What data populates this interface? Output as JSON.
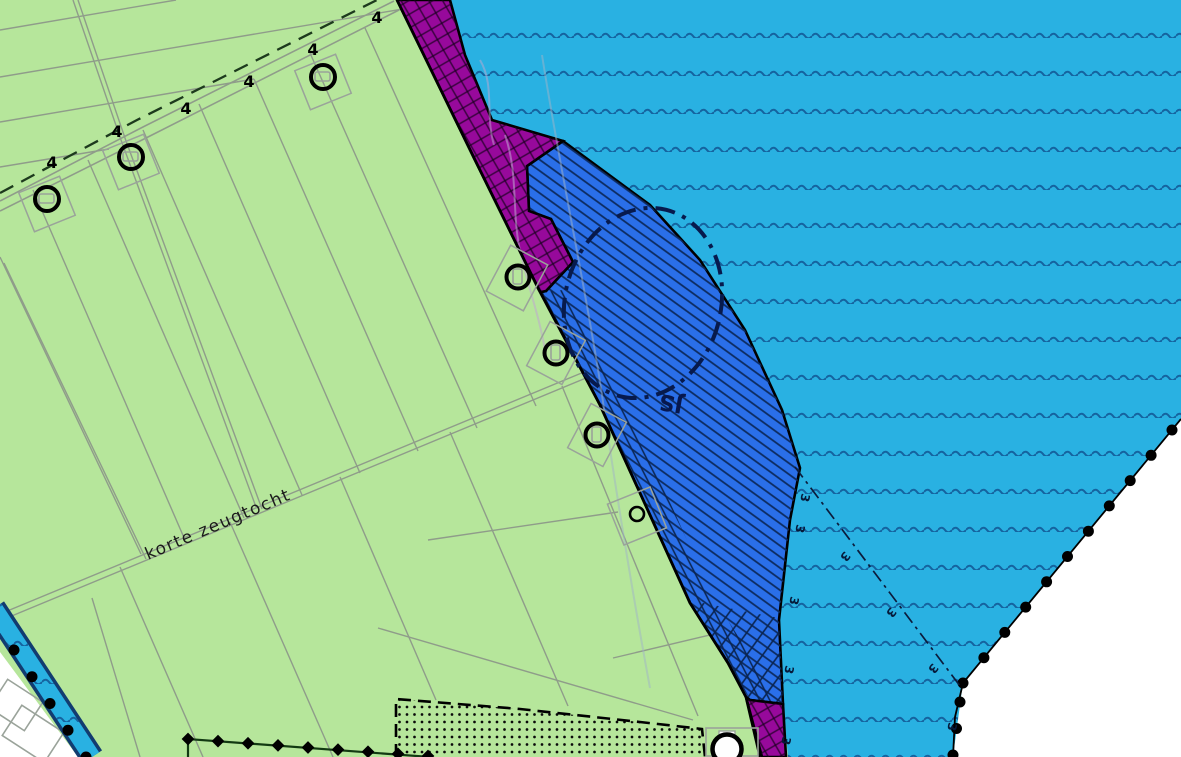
{
  "labels": {
    "waterway_name": "korte zeugtocht",
    "road_number": "4",
    "depth_number": "3",
    "area_code": "JS"
  },
  "colors": {
    "field_green": "#b6e69b",
    "water_cyan": "#29b1e2",
    "zone_blue": "#2a6fe9",
    "zone_purple": "#97099b",
    "outside_white": "#ffffff",
    "wave_blue": "#15639f",
    "hatch_navy": "#0c2a5e",
    "parcel_gray": "#8f9c8a",
    "boundary_black": "#000000",
    "border_dark_green": "#123a12"
  },
  "symbols": {
    "plan_boundary_marker": "black-dot",
    "municipal_boundary_marker": "black-diamond",
    "water_symbol": "wave-lines",
    "building_symbol": "circle-with-rect"
  }
}
